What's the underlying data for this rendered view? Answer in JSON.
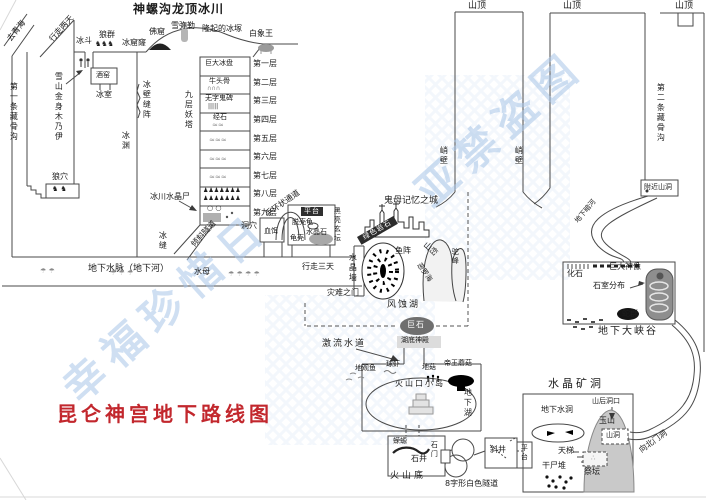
{
  "colors": {
    "ink": "#1c1c1c",
    "line": "#4a4a4a",
    "title_red": "#c2272d",
    "watermark_blue": "#a9c6e8"
  },
  "labels": [
    {
      "id": "qinghai-exit-label",
      "text": "去青海",
      "x": 6,
      "y": 38,
      "fs": 8,
      "rot": -52
    },
    {
      "id": "glacier-title",
      "text": "神螺沟龙顶冰川",
      "x": 133,
      "y": 3,
      "fs": 12,
      "cls": "bold"
    },
    {
      "id": "walk-two-days-label",
      "text": "行走两天",
      "x": 48,
      "y": 38,
      "fs": 8,
      "rot": -48
    },
    {
      "id": "cirque-label",
      "text": "冰斗",
      "x": 76,
      "y": 37,
      "fs": 8
    },
    {
      "id": "wolf-pack-label",
      "text": "狼群",
      "x": 99,
      "y": 31,
      "fs": 8
    },
    {
      "id": "wolf-pack-icons",
      "text": "♞♞♞",
      "x": 95,
      "y": 41,
      "fs": 7
    },
    {
      "id": "ice-hole-label",
      "text": "冰窟窿",
      "x": 122,
      "y": 39,
      "fs": 8
    },
    {
      "id": "buddha-grotto-label",
      "text": "佛窟",
      "x": 149,
      "y": 28,
      "fs": 8
    },
    {
      "id": "snow-maitreya-label",
      "text": "雪弥勒",
      "x": 171,
      "y": 22,
      "fs": 8
    },
    {
      "id": "raised-ice-label",
      "text": "隆起的冰塚",
      "x": 202,
      "y": 25,
      "fs": 8
    },
    {
      "id": "white-elephant-label",
      "text": "白象王",
      "x": 249,
      "y": 30,
      "fs": 8
    },
    {
      "id": "summit-label-1",
      "text": "山顶",
      "x": 468,
      "y": 2,
      "fs": 9
    },
    {
      "id": "summit-label-2",
      "text": "山顶",
      "x": 563,
      "y": 2,
      "fs": 9
    },
    {
      "id": "summit-label-3",
      "text": "山顶",
      "x": 675,
      "y": 2,
      "fs": 9
    },
    {
      "id": "first-bone-gully-label",
      "text": "第一条藏骨沟",
      "x": 9,
      "y": 82,
      "fs": 8,
      "vert": true
    },
    {
      "id": "mummy-label",
      "text": "雪山金身木乃伊",
      "x": 54,
      "y": 72,
      "fs": 8,
      "vert": true
    },
    {
      "id": "wine-cellar-label",
      "text": "酒窑",
      "x": 96,
      "y": 72,
      "fs": 7
    },
    {
      "id": "ice-room-label",
      "text": "冰室",
      "x": 96,
      "y": 91,
      "fs": 8
    },
    {
      "id": "ice-wall-cracks-label",
      "text": "冰壁缝阵",
      "x": 142,
      "y": 80,
      "fs": 8,
      "vert": true
    },
    {
      "id": "ice-abyss-label",
      "text": "冰渊",
      "x": 121,
      "y": 131,
      "fs": 8,
      "vert": true
    },
    {
      "id": "nine-tower-label",
      "text": "九层妖塔",
      "x": 184,
      "y": 90,
      "fs": 8,
      "vert": true
    },
    {
      "id": "floor1-item",
      "text": "巨大冰盘",
      "x": 205,
      "y": 60,
      "fs": 7
    },
    {
      "id": "floor1-label",
      "text": "第一层",
      "x": 253,
      "y": 60,
      "fs": 8
    },
    {
      "id": "floor2-item",
      "text": "牛头骨",
      "x": 209,
      "y": 78,
      "fs": 7
    },
    {
      "id": "floor2-icons",
      "text": "∩∩∩",
      "x": 207,
      "y": 86,
      "fs": 6,
      "cls": "gy"
    },
    {
      "id": "floor2-label",
      "text": "第二层",
      "x": 253,
      "y": 79,
      "fs": 8
    },
    {
      "id": "floor3-item",
      "text": "无字鬼碑",
      "x": 205,
      "y": 95,
      "fs": 7
    },
    {
      "id": "floor3-icons",
      "text": "|||||",
      "x": 208,
      "y": 104,
      "fs": 6
    },
    {
      "id": "floor3-label",
      "text": "第三层",
      "x": 253,
      "y": 97,
      "fs": 8
    },
    {
      "id": "floor4-item",
      "text": "经石",
      "x": 213,
      "y": 114,
      "fs": 7
    },
    {
      "id": "floor4-icons",
      "text": "≈≈",
      "x": 212,
      "y": 122,
      "fs": 7,
      "cls": "gy"
    },
    {
      "id": "floor4-label",
      "text": "第四层",
      "x": 253,
      "y": 116,
      "fs": 8
    },
    {
      "id": "floor5-icons",
      "text": "≈≈≈",
      "x": 209,
      "y": 137,
      "fs": 7,
      "cls": "gy"
    },
    {
      "id": "floor5-label",
      "text": "第五层",
      "x": 253,
      "y": 135,
      "fs": 8
    },
    {
      "id": "floor6-icons",
      "text": "≈≈≈",
      "x": 209,
      "y": 156,
      "fs": 7,
      "cls": "gy"
    },
    {
      "id": "floor6-label",
      "text": "第六层",
      "x": 253,
      "y": 153,
      "fs": 8
    },
    {
      "id": "floor7-icons",
      "text": "≈≈≈",
      "x": 209,
      "y": 174,
      "fs": 7,
      "cls": "gy"
    },
    {
      "id": "floor7-label",
      "text": "第七层",
      "x": 253,
      "y": 172,
      "fs": 8
    },
    {
      "id": "floor8-icons-1",
      "text": "♟♟♟♟♟♟♟",
      "x": 203,
      "y": 188,
      "fs": 6
    },
    {
      "id": "floor8-icons-2",
      "text": "♟♟♟♟♟♟♟",
      "x": 203,
      "y": 196,
      "fs": 6
    },
    {
      "id": "floor8-label",
      "text": "第八层",
      "x": 253,
      "y": 190,
      "fs": 8
    },
    {
      "id": "floor9-icons",
      "text": "○ ○",
      "x": 207,
      "y": 205,
      "fs": 7
    },
    {
      "id": "floor9-label",
      "text": "第九层",
      "x": 253,
      "y": 209,
      "fs": 8
    },
    {
      "id": "crystal-corpse-label",
      "text": "冰川水晶尸",
      "x": 150,
      "y": 193,
      "fs": 8
    },
    {
      "id": "wolf-den-label",
      "text": "狼穴",
      "x": 52,
      "y": 173,
      "fs": 8
    },
    {
      "id": "wolf-den-icons",
      "text": "♞ ♞",
      "x": 52,
      "y": 186,
      "fs": 7
    },
    {
      "id": "underground-vein-label",
      "text": "地下水脉（地下河）",
      "x": 88,
      "y": 265,
      "fs": 9
    },
    {
      "id": "jellyfish-label",
      "text": "水母",
      "x": 194,
      "y": 268,
      "fs": 8
    },
    {
      "id": "jellyfish-icons-1",
      "text": "☂ ☂ ☂",
      "x": 110,
      "y": 270,
      "fs": 7,
      "cls": "gy"
    },
    {
      "id": "jellyfish-icons-2",
      "text": "☂ ☂ ☂ ☂",
      "x": 228,
      "y": 271,
      "fs": 7,
      "cls": "gy"
    },
    {
      "id": "jellyfish-icons-3",
      "text": "☂ ☂",
      "x": 40,
      "y": 268,
      "fs": 7,
      "cls": "gy"
    },
    {
      "id": "walk-three-days-label",
      "text": "行走三天",
      "x": 302,
      "y": 263,
      "fs": 8
    },
    {
      "id": "inclined-tunnel-label",
      "text": "倾斜隧道",
      "x": 190,
      "y": 243,
      "fs": 8,
      "rot": -47
    },
    {
      "id": "ice-crevice-label",
      "text": "冰缝",
      "x": 158,
      "y": 231,
      "fs": 8,
      "vert": true
    },
    {
      "id": "cave-label",
      "text": "洞穴",
      "x": 241,
      "y": 222,
      "fs": 8
    },
    {
      "id": "bracelet-passage-label",
      "text": "手环状通道",
      "x": 264,
      "y": 212,
      "fs": 8,
      "rot": -35
    },
    {
      "id": "blood-bait-label",
      "text": "血饵",
      "x": 264,
      "y": 228,
      "fs": 7
    },
    {
      "id": "platform-label-1",
      "text": "平台",
      "x": 301,
      "y": 207,
      "fs": 7,
      "cls": "dark"
    },
    {
      "id": "shell-turtle-label",
      "text": "脱壳龟",
      "x": 292,
      "y": 219,
      "fs": 7
    },
    {
      "id": "crystal-stone-label",
      "text": "水晶石",
      "x": 306,
      "y": 229,
      "fs": 7
    },
    {
      "id": "turtle-shell-label",
      "text": "龟壳",
      "x": 290,
      "y": 235,
      "fs": 7
    },
    {
      "id": "black-altar-label",
      "text": "黑亮玄坛",
      "x": 333,
      "y": 207,
      "fs": 7,
      "vert": true
    },
    {
      "id": "crystal-wall-label",
      "text": "水晶墙",
      "x": 348,
      "y": 253,
      "fs": 8,
      "vert": true
    },
    {
      "id": "disaster-gate-label",
      "text": "灾难之门",
      "x": 327,
      "y": 289,
      "fs": 8
    },
    {
      "id": "cliff-label-1",
      "text": "峭壁",
      "x": 439,
      "y": 146,
      "fs": 8,
      "vert": true
    },
    {
      "id": "cliff-label-2",
      "text": "峭壁",
      "x": 514,
      "y": 146,
      "fs": 8,
      "vert": true
    },
    {
      "id": "ghost-city-label",
      "text": "鬼母记忆之城",
      "x": 384,
      "y": 197,
      "fs": 9
    },
    {
      "id": "green-rock-label",
      "text": "绿色岩石",
      "x": 357,
      "y": 237,
      "fs": 7,
      "rot": -30,
      "cls": "darkband"
    },
    {
      "id": "fish-array-label",
      "text": "鱼阵",
      "x": 395,
      "y": 247,
      "fs": 8
    },
    {
      "id": "hill-label",
      "text": "山峦",
      "x": 427,
      "y": 241,
      "fs": 8,
      "rot": 42
    },
    {
      "id": "eluohai-label",
      "text": "恶罗海",
      "x": 421,
      "y": 262,
      "fs": 7,
      "rot": 55
    },
    {
      "id": "camel-hump-label",
      "text": "驼峰",
      "x": 451,
      "y": 248,
      "fs": 7,
      "vert": true
    },
    {
      "id": "wind-lake-label",
      "text": "风蚀湖",
      "x": 387,
      "y": 301,
      "fs": 9,
      "cls": "ls2"
    },
    {
      "id": "boulder-label",
      "text": "巨石",
      "x": 407,
      "y": 321,
      "fs": 8,
      "cls": "ondark"
    },
    {
      "id": "lake-temple-label",
      "text": "湖底神殿",
      "x": 401,
      "y": 337,
      "fs": 7
    },
    {
      "id": "torrent-label",
      "text": "激流水道",
      "x": 322,
      "y": 340,
      "fs": 9,
      "cls": "ls2"
    },
    {
      "id": "ground-fish-label",
      "text": "地观鱼",
      "x": 355,
      "y": 365,
      "fs": 7
    },
    {
      "id": "ball-shrimp-label",
      "text": "球虾",
      "x": 386,
      "y": 361,
      "fs": 7
    },
    {
      "id": "ground-mushroom-label",
      "text": "地菇",
      "x": 422,
      "y": 364,
      "fs": 7
    },
    {
      "id": "emperor-mushroom-label",
      "text": "帝王蘑菇",
      "x": 444,
      "y": 360,
      "fs": 7
    },
    {
      "id": "crater-island-label",
      "text": "火山口小岛",
      "x": 395,
      "y": 380,
      "fs": 8,
      "cls": "ls2"
    },
    {
      "id": "underground-lake-label",
      "text": "地下湖",
      "x": 463,
      "y": 388,
      "fs": 8,
      "vert": true
    },
    {
      "id": "salamander-label",
      "text": "蝾螈",
      "x": 393,
      "y": 438,
      "fs": 7
    },
    {
      "id": "stone-gate-label",
      "text": "石门",
      "x": 430,
      "y": 441,
      "fs": 7,
      "vert": true
    },
    {
      "id": "stone-well-label",
      "text": "石井",
      "x": 411,
      "y": 455,
      "fs": 8
    },
    {
      "id": "volcano-bottom-label",
      "text": "火山底",
      "x": 390,
      "y": 472,
      "fs": 9,
      "cls": "ls3"
    },
    {
      "id": "tunnel8-label",
      "text": "8字形白色隧道",
      "x": 445,
      "y": 480,
      "fs": 8
    },
    {
      "id": "inclined-shaft-label",
      "text": "斜井",
      "x": 490,
      "y": 446,
      "fs": 8
    },
    {
      "id": "platform-label-2",
      "text": "平台",
      "x": 520,
      "y": 444,
      "fs": 7,
      "vert": true
    },
    {
      "id": "crystal-mine-label",
      "text": "水晶矿洞",
      "x": 548,
      "y": 378,
      "fs": 11,
      "cls": "ls3"
    },
    {
      "id": "water-cave-label",
      "text": "地下水洞",
      "x": 541,
      "y": 406,
      "fs": 8
    },
    {
      "id": "back-mouth-label",
      "text": "山后洞口",
      "x": 592,
      "y": 398,
      "fs": 7
    },
    {
      "id": "jade-mountain-label",
      "text": "玉山",
      "x": 599,
      "y": 417,
      "fs": 8
    },
    {
      "id": "mountain-cave-label",
      "text": "山洞",
      "x": 606,
      "y": 432,
      "fs": 7
    },
    {
      "id": "sky-ladder-label",
      "text": "天梯",
      "x": 558,
      "y": 447,
      "fs": 8
    },
    {
      "id": "corpse-pile-label",
      "text": "干尸堆",
      "x": 542,
      "y": 462,
      "fs": 8
    },
    {
      "id": "altar-label",
      "text": "祭坛",
      "x": 584,
      "y": 468,
      "fs": 8
    },
    {
      "id": "altar-icons",
      "text": "∴",
      "x": 591,
      "y": 455,
      "fs": 7,
      "cls": "gy"
    },
    {
      "id": "north-gate-label",
      "text": "向北门洞",
      "x": 638,
      "y": 448,
      "fs": 8,
      "rot": -36
    },
    {
      "id": "nearby-cave-label",
      "text": "附近山洞",
      "x": 644,
      "y": 184,
      "fs": 7
    },
    {
      "id": "dark-river-label",
      "text": "地下暗河",
      "x": 574,
      "y": 220,
      "fs": 7,
      "rot": -50
    },
    {
      "id": "fossil-label",
      "text": "化石",
      "x": 567,
      "y": 270,
      "fs": 8
    },
    {
      "id": "giant-statue-label",
      "text": "巨大神像",
      "x": 609,
      "y": 263,
      "fs": 8
    },
    {
      "id": "chambers-label",
      "text": "石室分布",
      "x": 593,
      "y": 282,
      "fs": 8
    },
    {
      "id": "snakes-label",
      "text": "蛇群",
      "x": 622,
      "y": 310,
      "fs": 8
    },
    {
      "id": "grand-canyon-label",
      "text": "地下大峡谷",
      "x": 598,
      "y": 327,
      "fs": 10,
      "cls": "ls2"
    },
    {
      "id": "second-bone-gully-label",
      "text": "第二条藏骨沟",
      "x": 656,
      "y": 83,
      "fs": 8,
      "vert": true
    },
    {
      "id": "map-title",
      "text": "昆仑神宫地下路线图",
      "x": 57,
      "y": 404,
      "fs": 20,
      "cls": "red"
    },
    {
      "id": "watermark-1",
      "text": "亚禁盗图",
      "x": 408,
      "y": 182,
      "fs": 42,
      "rot": -42,
      "cls": "wm"
    },
    {
      "id": "watermark-2",
      "text": "幸福珍惜日",
      "x": 55,
      "y": 378,
      "fs": 42,
      "rot": -42,
      "cls": "wm"
    }
  ]
}
